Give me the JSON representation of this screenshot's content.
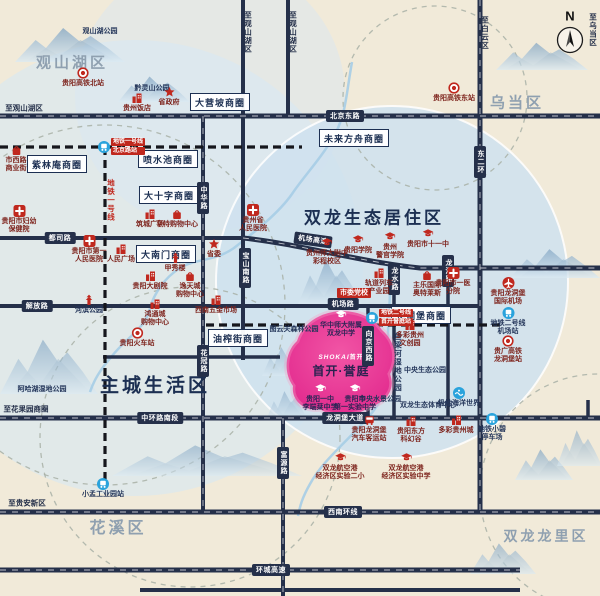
{
  "map": {
    "compass": {
      "label": "N"
    },
    "project": {
      "logo_en": "SHOKAI",
      "logo_cn": "首开",
      "name": "首开·誉庭",
      "x": 341,
      "y": 352
    },
    "colors": {
      "road": "#25304a",
      "red": "#c0281e",
      "maroon": "#7e241d",
      "navy": "#24365a",
      "metro_blue": "#2aa3dc",
      "pink": "#e8368f",
      "district_gray": "#8fa0b0",
      "district_navy": "#1c2f52",
      "zone_blue": "#cfe2f0",
      "background": "#f1ead9"
    },
    "districts": [
      {
        "id": "guanshanhu",
        "label": "观山湖区",
        "x": 72,
        "y": 62,
        "fs": 15,
        "navy": false
      },
      {
        "id": "wudang",
        "label": "乌当区",
        "x": 517,
        "y": 102,
        "fs": 15,
        "navy": false
      },
      {
        "id": "huaxi",
        "label": "花溪区",
        "x": 118,
        "y": 526,
        "fs": 16,
        "navy": false
      },
      {
        "id": "shuanglong-longli",
        "label": "双龙龙里区",
        "x": 546,
        "y": 536,
        "fs": 14,
        "navy": false
      },
      {
        "id": "shuanglong-eco",
        "label": "双龙生态居住区",
        "x": 374,
        "y": 216,
        "fs": 17,
        "navy": true
      },
      {
        "id": "main-city",
        "label": "主城生活区",
        "x": 155,
        "y": 384,
        "fs": 19,
        "navy": true
      }
    ],
    "business_circles": [
      {
        "id": "dayingpo",
        "label": "大营坡商圈",
        "x": 220,
        "y": 102
      },
      {
        "id": "zilinan",
        "label": "紫林庵商圈",
        "x": 57,
        "y": 164
      },
      {
        "id": "penshuichi",
        "label": "喷水池商圈",
        "x": 168,
        "y": 159
      },
      {
        "id": "dashizi",
        "label": "大十字商圈",
        "x": 169,
        "y": 195
      },
      {
        "id": "dananmen",
        "label": "大南门商圈",
        "x": 166,
        "y": 254
      },
      {
        "id": "weilai-fangzhou",
        "label": "未来方舟商圈",
        "x": 354,
        "y": 138
      },
      {
        "id": "youzhajie",
        "label": "油榨街商圈",
        "x": 238,
        "y": 338
      },
      {
        "id": "longdongbao",
        "label": "龙洞堡商圈",
        "x": 421,
        "y": 315
      }
    ],
    "road_pills": [
      {
        "label": "北京东路",
        "x": 345,
        "y": 116
      },
      {
        "label": "都司路",
        "x": 60,
        "y": 238
      },
      {
        "label": "解放路",
        "x": 37,
        "y": 306
      },
      {
        "label": "机场高速",
        "x": 313,
        "y": 240,
        "angle": 8
      },
      {
        "label": "机场路",
        "x": 343,
        "y": 304
      },
      {
        "label": "中环路南段",
        "x": 160,
        "y": 418
      },
      {
        "label": "龙洞堡大道",
        "x": 345,
        "y": 418
      },
      {
        "label": "西南环线",
        "x": 343,
        "y": 512
      },
      {
        "label": "环城高速",
        "x": 271,
        "y": 570
      },
      {
        "label": "中华路",
        "x": 203,
        "y": 198,
        "v": true
      },
      {
        "label": "花冠路",
        "x": 203,
        "y": 361,
        "v": true
      },
      {
        "label": "宝山南路",
        "x": 245,
        "y": 268,
        "v": true
      },
      {
        "label": "东二环",
        "x": 480,
        "y": 162,
        "v": true
      },
      {
        "label": "龙水路",
        "x": 394,
        "y": 279,
        "v": true
      },
      {
        "label": "龙洞路",
        "x": 448,
        "y": 271,
        "v": true
      },
      {
        "label": "向京西路",
        "x": 368,
        "y": 346,
        "v": true
      },
      {
        "label": "富源路",
        "x": 283,
        "y": 463,
        "v": true
      }
    ],
    "edge_labels": [
      {
        "label": "至观山湖区",
        "x": 24,
        "y": 108
      },
      {
        "label": "至花果园商圈",
        "x": 26,
        "y": 409
      },
      {
        "label": "至贵安新区",
        "x": 27,
        "y": 503
      },
      {
        "label": "至观山湖区",
        "x": 248,
        "y": 32,
        "v": true
      },
      {
        "label": "至观山湖区",
        "x": 293,
        "y": 32,
        "v": true
      },
      {
        "label": "至白云区",
        "x": 485,
        "y": 33,
        "v": true
      },
      {
        "label": "至乌当区",
        "x": 593,
        "y": 30,
        "v": true
      },
      {
        "label": "地铁一号线",
        "x": 111,
        "y": 200,
        "v": true,
        "red": true
      },
      {
        "label": "鱼梁河湿地公园",
        "x": 398,
        "y": 362,
        "v": true,
        "navy": true
      }
    ],
    "metro_stations": [
      {
        "id": "metro-line1-beijing-rd-station",
        "x": 104,
        "y": 147,
        "tags": [
          "地铁一号线",
          "北京路站"
        ]
      },
      {
        "id": "metro-line2-project-station",
        "x": 372,
        "y": 318,
        "tags": [
          "地铁二号线",
          "首开誉庭站"
        ]
      }
    ],
    "pois": [
      {
        "id": "guanshanhu-park",
        "icon": "none",
        "x": 100,
        "y": 32,
        "lines": [
          "观山湖公园"
        ],
        "c": "nv"
      },
      {
        "id": "qianlingshan-park",
        "icon": "none",
        "x": 152,
        "y": 89,
        "lines": [
          "黔灵山公园"
        ],
        "c": "nv"
      },
      {
        "id": "north-hsr-station",
        "icon": "rail",
        "x": 83,
        "y": 73,
        "lines": [
          "贵阳高铁北站"
        ],
        "c": "mr"
      },
      {
        "id": "guizhou-hotel",
        "icon": "building",
        "x": 137,
        "y": 98,
        "lines": [
          "贵州饭店"
        ],
        "c": "mr"
      },
      {
        "id": "provincial-government",
        "icon": "star",
        "x": 169,
        "y": 92,
        "lines": [
          "省政府"
        ],
        "c": "mr"
      },
      {
        "id": "east-hsr-station",
        "icon": "rail",
        "x": 454,
        "y": 88,
        "lines": [
          "贵阳高铁东站"
        ],
        "c": "mr"
      },
      {
        "id": "shixilu-biz-street",
        "icon": "bag",
        "x": 16,
        "y": 150,
        "lines": [
          "市西路",
          "商业街"
        ],
        "c": "mr"
      },
      {
        "id": "fuyou-hospital",
        "icon": "cross",
        "x": 19,
        "y": 211,
        "lines": [
          "贵阳市妇幼",
          "保健院"
        ],
        "c": "mr"
      },
      {
        "id": "first-peoples-hospital",
        "icon": "cross",
        "x": 89,
        "y": 241,
        "lines": [
          "贵阳市第一",
          "人民医院"
        ],
        "c": "mr"
      },
      {
        "id": "renmin-square",
        "icon": "building",
        "x": 121,
        "y": 249,
        "lines": [
          "人民广场"
        ],
        "c": "mr"
      },
      {
        "id": "zhucheng-square",
        "icon": "building",
        "x": 150,
        "y": 214,
        "lines": [
          "筑城广场"
        ],
        "c": "mr"
      },
      {
        "id": "hunter-mall",
        "icon": "bag",
        "x": 177,
        "y": 214,
        "lines": [
          "亨特购物中心"
        ],
        "c": "mr"
      },
      {
        "id": "provincial-peoples-hospital",
        "icon": "cross",
        "x": 253,
        "y": 210,
        "lines": [
          "贵州省",
          "人民医院"
        ],
        "c": "mr"
      },
      {
        "id": "provincial-committee",
        "icon": "star",
        "x": 214,
        "y": 244,
        "lines": [
          "省委"
        ],
        "c": "mr"
      },
      {
        "id": "jiaxiu-tower",
        "icon": "pagoda",
        "x": 175,
        "y": 258,
        "lines": [
          "甲秀楼"
        ],
        "c": "mr"
      },
      {
        "id": "guiyang-grand-theatre",
        "icon": "building",
        "x": 150,
        "y": 276,
        "lines": [
          "贵阳大剧院"
        ],
        "c": "mr"
      },
      {
        "id": "yitiancheng-mall",
        "icon": "bag",
        "x": 190,
        "y": 276,
        "lines": [
          "逸天城",
          "购物中心"
        ],
        "c": "mr"
      },
      {
        "id": "hebin-park",
        "icon": "pagoda",
        "x": 89,
        "y": 300,
        "lines": [
          "河滨公园"
        ],
        "c": "nv"
      },
      {
        "id": "hongtongcheng-mall",
        "icon": "building",
        "x": 155,
        "y": 304,
        "lines": [
          "鸿通城",
          "购物中心"
        ],
        "c": "mr"
      },
      {
        "id": "guiyang-railway-station",
        "icon": "rail",
        "x": 137,
        "y": 333,
        "lines": [
          "贵阳火车站"
        ],
        "c": "mr"
      },
      {
        "id": "hardware-market",
        "icon": "building",
        "x": 216,
        "y": 300,
        "lines": [
          "西南五金市场"
        ],
        "c": "mr"
      },
      {
        "id": "tuyunguan-forest-park",
        "icon": "none",
        "x": 294,
        "y": 330,
        "lines": [
          "图云关森林公园"
        ],
        "c": "nv"
      },
      {
        "id": "normal-univ-high-school",
        "icon": "cap",
        "x": 327,
        "y": 243,
        "lines": [
          "贵州师大附中",
          "彩程校区"
        ],
        "c": "mr"
      },
      {
        "id": "guiyang-college",
        "icon": "cap",
        "x": 358,
        "y": 240,
        "lines": [
          "贵阳学院"
        ],
        "c": "mr"
      },
      {
        "id": "police-college",
        "icon": "cap",
        "x": 390,
        "y": 237,
        "lines": [
          "贵州",
          "警官学院"
        ],
        "c": "mr"
      },
      {
        "id": "no11-middle-school",
        "icon": "cap",
        "x": 428,
        "y": 234,
        "lines": [
          "贵阳市十一中"
        ],
        "c": "mr"
      },
      {
        "id": "party-school",
        "icon": "redbox",
        "x": 354,
        "y": 286,
        "lines": [
          "市委党校"
        ],
        "c": "mr"
      },
      {
        "id": "rail-industry-park",
        "icon": "building",
        "x": 379,
        "y": 273,
        "lines": [
          "轨道列车",
          "产业园"
        ],
        "c": "mr"
      },
      {
        "id": "outlets",
        "icon": "bag",
        "x": 427,
        "y": 275,
        "lines": [
          "主乐国际",
          "奥特莱斯"
        ],
        "c": "mr"
      },
      {
        "id": "first-hospital-branch",
        "icon": "cross",
        "x": 453,
        "y": 273,
        "lines": [
          "贵阳市一医",
          "分院"
        ],
        "c": "mr"
      },
      {
        "id": "longdongbao-airport",
        "icon": "plane",
        "x": 508,
        "y": 283,
        "lines": [
          "贵阳龙洞堡",
          "国际机场"
        ],
        "c": "mr"
      },
      {
        "id": "metro2-airport-station",
        "icon": "metro",
        "x": 508,
        "y": 313,
        "lines": [
          "地铁二号线",
          "机场站"
        ],
        "c": "nv"
      },
      {
        "id": "hsr-longdongbao-station",
        "icon": "rail",
        "x": 508,
        "y": 341,
        "lines": [
          "贵广高铁",
          "龙洞堡站"
        ],
        "c": "mr"
      },
      {
        "id": "duocai-culture-park",
        "icon": "building",
        "x": 410,
        "y": 325,
        "lines": [
          "多彩贵州",
          "文创园"
        ],
        "c": "mr"
      },
      {
        "id": "central-eco-park",
        "icon": "none",
        "x": 425,
        "y": 371,
        "lines": [
          "中央生态公园"
        ],
        "c": "nv"
      },
      {
        "id": "central-water-park",
        "icon": "none",
        "x": 380,
        "y": 400,
        "lines": [
          "中央水景公园"
        ],
        "c": "nv"
      },
      {
        "id": "sports-center",
        "icon": "none",
        "x": 428,
        "y": 406,
        "lines": [
          "双龙生态体育中心"
        ],
        "c": "nv"
      },
      {
        "id": "polar-ocean-world",
        "icon": "wave",
        "x": 459,
        "y": 393,
        "lines": [
          "极地海洋世界"
        ],
        "c": "nv"
      },
      {
        "id": "bus-terminal",
        "icon": "bus",
        "x": 369,
        "y": 420,
        "lines": [
          "贵阳龙洞堡",
          "汽车客运站"
        ],
        "c": "mr"
      },
      {
        "id": "scifi-valley",
        "icon": "building",
        "x": 411,
        "y": 421,
        "lines": [
          "贵阳东方",
          "科幻谷"
        ],
        "c": "mr"
      },
      {
        "id": "duocai-guizhou-city",
        "icon": "building",
        "x": 456,
        "y": 420,
        "lines": [
          "多彩贵州城"
        ],
        "c": "mr"
      },
      {
        "id": "exp-primary-school",
        "icon": "cap",
        "x": 340,
        "y": 458,
        "lines": [
          "双龙航空港",
          "经济区实验二小"
        ],
        "c": "mr"
      },
      {
        "id": "exp-middle-school",
        "icon": "cap",
        "x": 406,
        "y": 458,
        "lines": [
          "双龙航空港",
          "经济区实验中学"
        ],
        "c": "mr"
      },
      {
        "id": "xiaobi-metro-depot",
        "icon": "metro",
        "x": 492,
        "y": 419,
        "lines": [
          "地铁小碧",
          "停车场"
        ],
        "c": "nv"
      },
      {
        "id": "xiaomeng-station",
        "icon": "metro",
        "x": 103,
        "y": 484,
        "lines": [
          "小孟工业园站"
        ],
        "c": "nv"
      },
      {
        "id": "ahahu-wetland-park",
        "icon": "none",
        "x": 42,
        "y": 390,
        "lines": [
          "阿哈湖湿地公园"
        ],
        "c": "nv"
      },
      {
        "id": "huazhong-normal-school",
        "icon": "capw",
        "x": 341,
        "y": 315,
        "lines": [
          "华中师大附属",
          "双龙中学"
        ],
        "c": "pk"
      },
      {
        "id": "lidaofen-school",
        "icon": "capw",
        "x": 320,
        "y": 389,
        "lines": [
          "贵阳一中",
          "李端棻中学"
        ],
        "c": "pk"
      },
      {
        "id": "first-exp-school",
        "icon": "capw",
        "x": 355,
        "y": 389,
        "lines": [
          "贵阳市",
          "第一实验中学"
        ],
        "c": "pk"
      }
    ]
  }
}
